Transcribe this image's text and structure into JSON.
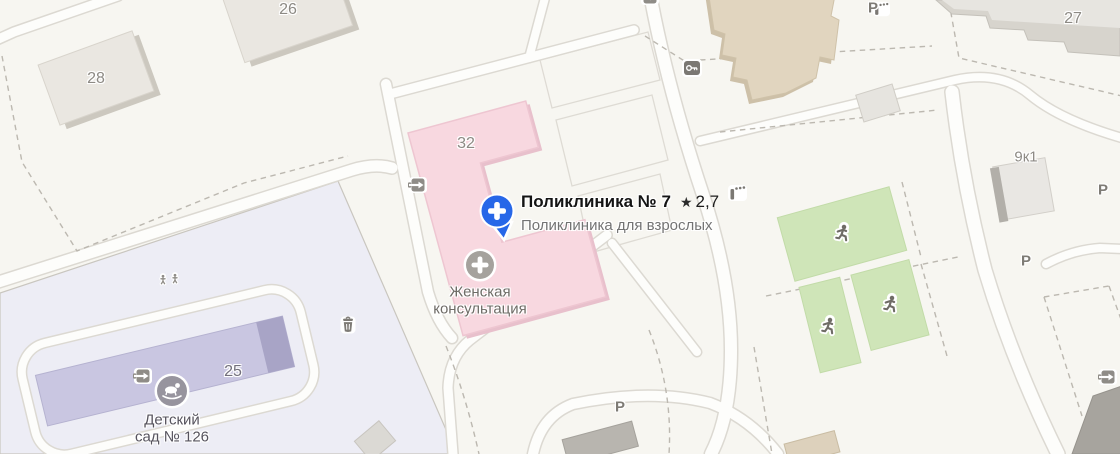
{
  "main_poi": {
    "title": "Поликлиника № 7",
    "star": "★",
    "rating": "2,7",
    "subtitle": "Поликлиника для взрослых"
  },
  "pois": {
    "womens_clinic": {
      "line1": "Женская",
      "line2": "консультация"
    },
    "kindergarten": {
      "line1": "Детский",
      "line2": "сад № 126"
    }
  },
  "buildings": {
    "b26": "26",
    "b28": "28",
    "b32": "32",
    "b27": "27",
    "b9k1": "9к1",
    "b25": "25"
  },
  "parking": {
    "label": "Р"
  },
  "icons": {
    "main_marker": "medical-cross-pin",
    "womens_clinic": "medical-cross-circle",
    "kindergarten": "rocking-horse-circle",
    "entrance": "entrance-arrow",
    "gate": "key-gate",
    "barrier": "barrier-post",
    "trash": "trash-can",
    "playground": "children-figures",
    "sports_field": "runner"
  },
  "colors": {
    "accent_blue": "#2767e8",
    "building_pink": "#f8d8e0",
    "grounds_lavender": "#ededf5",
    "kindergarten_purple": "#c9c6e1",
    "field_green": "#cfe5b8",
    "background": "#f7f6f1"
  }
}
